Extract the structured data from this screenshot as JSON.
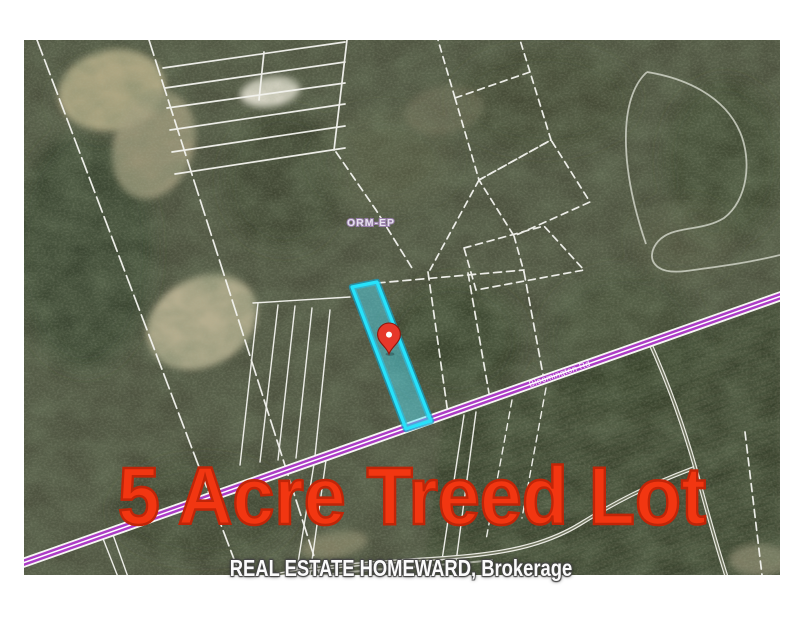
{
  "map_labels": {
    "zoning": "ORM-EP",
    "road": "Bloomington Rd"
  },
  "overlays": {
    "headline": "5 Acre Treed Lot",
    "brokerage": "REAL ESTATE HOMEWARD, Brokerage"
  },
  "colors": {
    "headline_fill": "#f23611",
    "headline_outline": "#c02508",
    "parcel_highlight": "#27e2fb",
    "route_highlight": "#ac3cc6",
    "pin": "#e6382a",
    "parcel_line": "#f3f3ee"
  }
}
